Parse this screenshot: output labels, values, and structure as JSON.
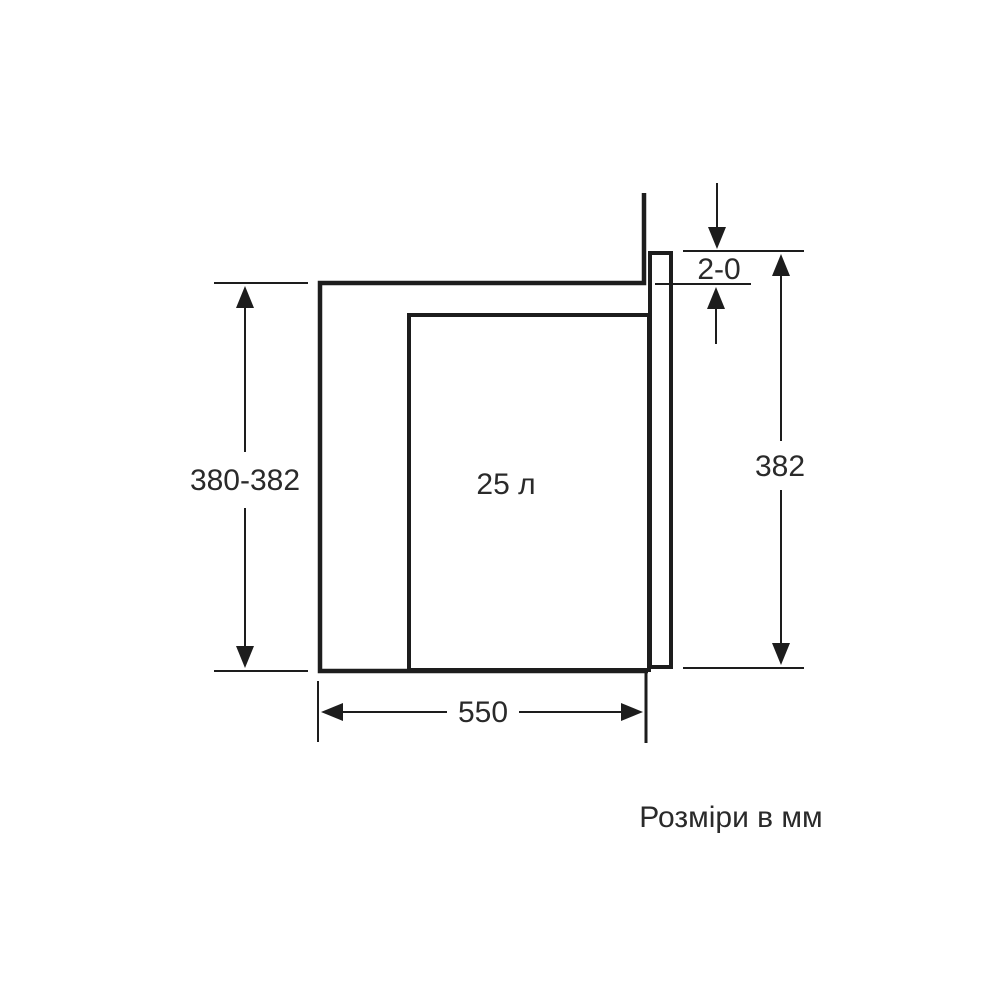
{
  "figure": {
    "capacity_label": "25 л",
    "caption": "Розміри в мм",
    "dimensions": {
      "niche_height": "380-382",
      "appliance_height": "382",
      "top_clearance": "2-0",
      "niche_width": "550"
    },
    "colors": {
      "line": "#1d1d1d",
      "text": "#2a2a2a",
      "background": "#ffffff"
    }
  }
}
